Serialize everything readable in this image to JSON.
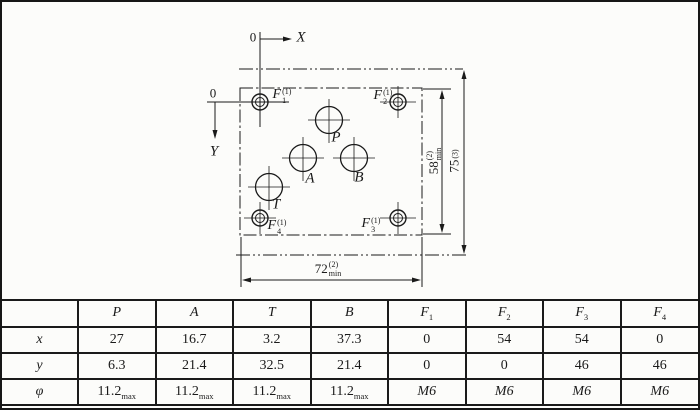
{
  "drawing": {
    "origin_top": "0",
    "origin_left": "0",
    "axis_x": "X",
    "axis_y": "Y",
    "ports": {
      "p": "P",
      "a": "A",
      "t": "T",
      "b": "B"
    },
    "holes": {
      "f1": {
        "base": "F",
        "sup": "(1)",
        "sub": "1"
      },
      "f2": {
        "base": "F",
        "sup": "(1)",
        "sub": "2"
      },
      "f3": {
        "base": "F",
        "sup": "(1)",
        "sub": "3"
      },
      "f4": {
        "base": "F",
        "sup": "(1)",
        "sub": "4"
      }
    },
    "dims": {
      "d58": {
        "base": "58",
        "sup": "(2)",
        "sub": "min"
      },
      "d75": {
        "base": "75",
        "sup": "(3)",
        "sub": ""
      },
      "d72": {
        "base": "72",
        "sup": "(2)",
        "sub": "min"
      }
    }
  },
  "table": {
    "headers": [
      {
        "b": "",
        "s": ""
      },
      {
        "b": "P",
        "s": ""
      },
      {
        "b": "A",
        "s": ""
      },
      {
        "b": "T",
        "s": ""
      },
      {
        "b": "B",
        "s": ""
      },
      {
        "b": "F",
        "s": "1"
      },
      {
        "b": "F",
        "s": "2"
      },
      {
        "b": "F",
        "s": "3"
      },
      {
        "b": "F",
        "s": "4"
      }
    ],
    "rows": [
      {
        "label": "x",
        "cells": [
          {
            "v": "27"
          },
          {
            "v": "16.7"
          },
          {
            "v": "3.2"
          },
          {
            "v": "37.3"
          },
          {
            "v": "0"
          },
          {
            "v": "54"
          },
          {
            "v": "54"
          },
          {
            "v": "0"
          }
        ]
      },
      {
        "label": "y",
        "cells": [
          {
            "v": "6.3"
          },
          {
            "v": "21.4"
          },
          {
            "v": "32.5"
          },
          {
            "v": "21.4"
          },
          {
            "v": "0"
          },
          {
            "v": "0"
          },
          {
            "v": "46"
          },
          {
            "v": "46"
          }
        ]
      },
      {
        "label": "φ",
        "cells": [
          {
            "v": "11.2",
            "s": "max"
          },
          {
            "v": "11.2",
            "s": "max"
          },
          {
            "v": "11.2",
            "s": "max"
          },
          {
            "v": "11.2",
            "s": "max"
          },
          {
            "v": "M6"
          },
          {
            "v": "M6"
          },
          {
            "v": "M6"
          },
          {
            "v": "M6"
          }
        ]
      }
    ]
  }
}
